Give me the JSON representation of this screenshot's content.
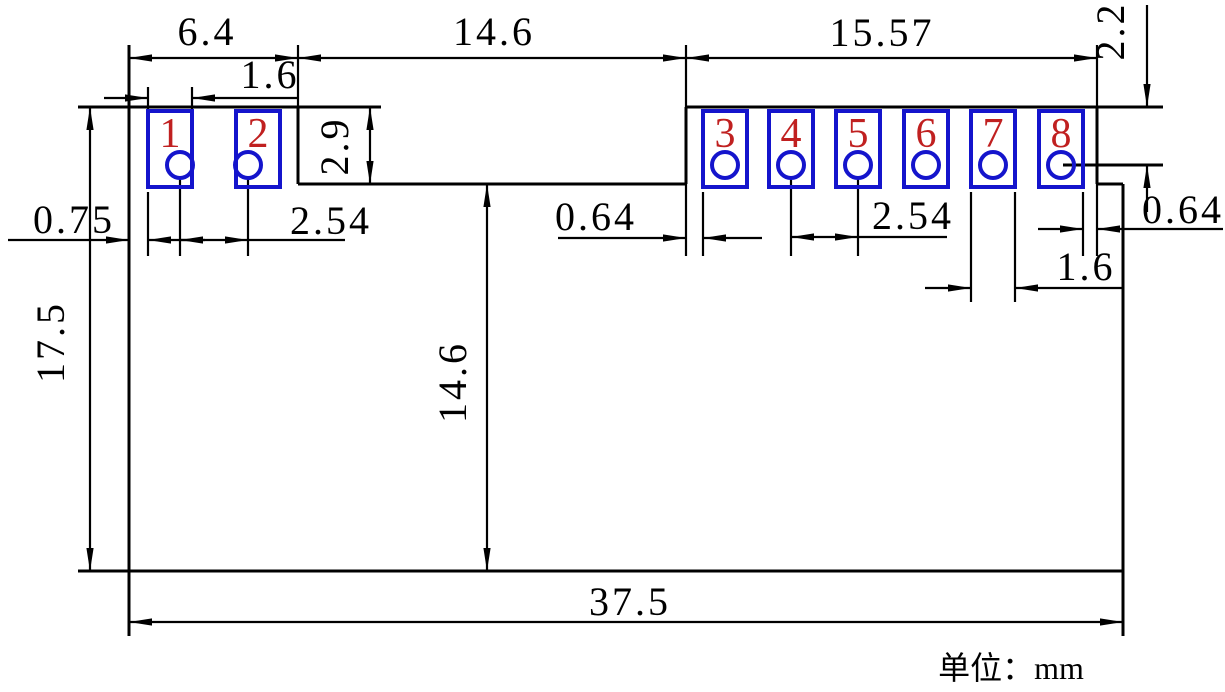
{
  "unit_label": "单位：mm",
  "colors": {
    "line": "#000000",
    "pad_outline": "#1414cc",
    "pad_number": "#c02020"
  },
  "pads": [
    {
      "number": "1"
    },
    {
      "number": "2"
    },
    {
      "number": "3"
    },
    {
      "number": "4"
    },
    {
      "number": "5"
    },
    {
      "number": "6"
    },
    {
      "number": "7"
    },
    {
      "number": "8"
    }
  ],
  "dimensions": {
    "left_section_width": "6.4",
    "middle_notch_width": "14.6",
    "right_section_width": "15.57",
    "hole_offset_from_top": "2.2",
    "pad1_width": "1.6",
    "notch_depth": "2.9",
    "edge_to_pad1": "0.75",
    "left_pitch": "2.54",
    "edge_to_pad3": "0.64",
    "right_pitch": "2.54",
    "pad8_to_edge": "0.64",
    "pad7_width": "1.6",
    "body_height": "17.5",
    "lower_body_height": "14.6",
    "body_width": "37.5"
  }
}
